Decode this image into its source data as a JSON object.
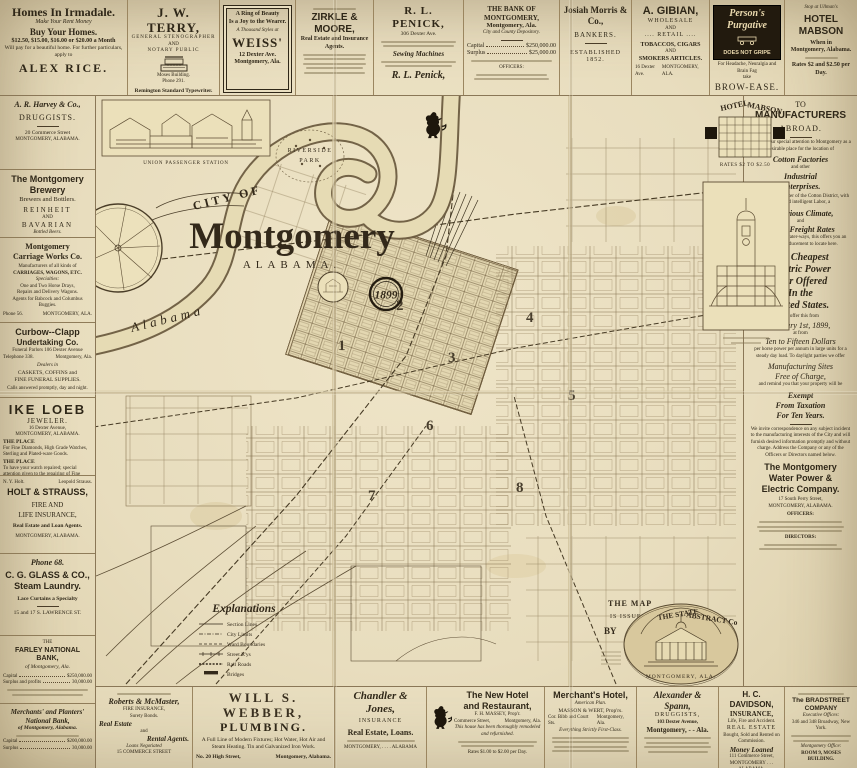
{
  "palette": {
    "paper": "#e9dec0",
    "ink": "#2f2718"
  },
  "map": {
    "ribbon": "CITY OF",
    "title": "Montgomery",
    "state": "ALABAMA.",
    "year": "1899",
    "river": "Alabama",
    "park1": "RIVERSIDE",
    "park2": "PARK",
    "station_caption": "UNION PASSENGER STATION",
    "wards": [
      "1",
      "2",
      "3",
      "4",
      "5",
      "6",
      "7",
      "8"
    ],
    "legend": {
      "title": "Explanations",
      "items": [
        "Section Lines",
        "City Limits",
        "Ward Boundaries",
        "Street R'ys",
        "Rail Roads",
        "Bridges"
      ]
    },
    "issued": {
      "l1": "THE MAP",
      "l2": "IS ISSUED",
      "l3": "BY",
      "n1": "THE STATE",
      "n2": "ABSTRACT Co",
      "city": "MONTGOMERY, ALA."
    }
  },
  "top": {
    "irmadale": {
      "title": "Homes In Irmadale.",
      "s1": "Make Your Rent Money",
      "s2": "Buy Your Homes.",
      "s3": "$12.50, $15.00, $16.00 or $20.00 a Month",
      "s4": "Will pay for a beautiful home. For further particulars, apply to",
      "name": "ALEX RICE."
    },
    "terry": {
      "title": "J. W. TERRY,",
      "l1": "GENERAL STENOGRAPHER",
      "l2": "AND",
      "l3": "NOTARY PUBLIC",
      "l4": "Moses Building.",
      "l5": "Phone 291.",
      "f1": "Remington Standard Typewriter.",
      "f2": "Typewriters to Rent."
    },
    "weiss": {
      "l1": "A Ring of Beauty",
      "l2": "Is a Joy to the Wearer.",
      "l3": "A Thousand Styles at",
      "name": "WEISS'",
      "a1": "12 Dexter Ave.",
      "a2": "Montgomery, Ala."
    },
    "zirkle": {
      "title": "ZIRKLE & MOORE,",
      "sub": "Real Estate and Insurance Agents."
    },
    "penick": {
      "title": "R. L. PENICK,",
      "sub": "306 Dexter Ave.",
      "mid": "Sewing Machines",
      "sig": "R. L. Penick,"
    },
    "bank": {
      "title": "THE BANK OF MONTGOMERY,",
      "sub": "Montgomery, Ala.",
      "dep": "City and County Depository.",
      "cl": "Capital",
      "cv": "$250,000.00",
      "sl": "Surplus",
      "sv": "$25,000.00",
      "off": "OFFICERS:"
    },
    "morris": {
      "title": "Josiah Morris & Co.,",
      "sub": "BANKERS.",
      "est": "ESTABLISHED 1852."
    },
    "gibian": {
      "title": "A. GIBIAN,",
      "l1": "WHOLESALE",
      "l2": "AND",
      "l3": ".... RETAIL ....",
      "l4": "TOBACCOS, CIGARS",
      "l5": "AND",
      "l6": "SMOKERS ARTICLES.",
      "a1": "16 Dexter Ave.",
      "a2": "MONTGOMERY, ALA."
    },
    "persons": {
      "b1": "Person's",
      "b2": "Purgative",
      "b3": "DOES NOT GRIPE",
      "n1": "For Headache, Neuralgia and Brain Fag",
      "n2": "take",
      "tag": "BROW-EASE."
    },
    "mabson": {
      "tiny": "Stop at Ullman's",
      "title": "HOTEL MABSON",
      "l1": "When in",
      "l2": "Montgomery, Alabama.",
      "rates": "Rates $2 and $2.50 per Day."
    }
  },
  "left": {
    "harvey": {
      "title": "A. R. Harvey & Co.,",
      "sub": "DRUGGISTS.",
      "a1": "20 Commerce Street",
      "a2": "MONTGOMERY, ALABAMA."
    },
    "brewery": {
      "t1": "The Montgomery",
      "t2": "Brewery",
      "sub": "Brewers and Bottlers.",
      "b1": "REINHEIT",
      "and": "AND",
      "b2": "BAVARIAN",
      "note": "Bottled Beers."
    },
    "carriage": {
      "t1": "Montgomery",
      "t2": "Carriage Works Co.",
      "l1": "Manufacturers of all kinds of",
      "l2": "CARRIAGES, WAGONS, ETC.",
      "l3": "Specialties:",
      "l4": "One and Two Horse Drays,",
      "l5": "Repairs and Delivery Wagons.",
      "l6": "Agents for Babcock and Columbus Buggies.",
      "phone": "Phone 56.",
      "city": "MONTGOMERY, ALA."
    },
    "curbow": {
      "t1": "Curbow--Clapp",
      "t2": "Undertaking Co.",
      "l1": "Funeral Parlors 106 Dexter Avenue",
      "l2": "Telephone 338.",
      "l3": "Montgomery, Ala.",
      "l4": "Dealers in",
      "l5": "CASKETS, COFFINS and",
      "l6": "FINE FUNERAL SUPPLIES.",
      "l7": "Calls answered promptly, day and night."
    },
    "loeb": {
      "title": "IKE LOEB",
      "sub": "JEWELER.",
      "a1": "16 Dexter Avenue,",
      "a2": "MONTGOMERY, ALABAMA.",
      "h1": "THE PLACE",
      "p1": "For Fine Diamonds, High Grade Watches, Sterling and Plated-ware Goods.",
      "h2": "THE PLACE",
      "p2": "To have your watch repaired; special attention given to the repairing of Fine Watches."
    },
    "holt": {
      "tiny1": "N. Y. Holt.",
      "tiny2": "Leopold Strauss.",
      "title": "HOLT & STRAUSS,",
      "l1": "FIRE AND",
      "l2": "LIFE INSURANCE,",
      "l3": "Real Estate and Loan Agents.",
      "city": "MONTGOMERY, ALABAMA."
    },
    "glass": {
      "phone": "Phone 68.",
      "t1": "C. G. GLASS & CO.,",
      "t2": "Steam Laundry.",
      "sub": "Lace Curtains a Specialty",
      "addr": "15 and 17 S. LAWRENCE ST."
    },
    "farley": {
      "pre": "THE",
      "title": "FARLEY NATIONAL BANK,",
      "sub": "of Montgomery, Ala.",
      "cl": "Capital",
      "cv": "$250,000.00",
      "sl": "Surplus and profits",
      "sv": "30,000.00"
    },
    "merchants": {
      "t1": "Merchants' and Planters'",
      "t2": "National Bank,",
      "sub": "of Montgomery, Alabama.",
      "cl": "Capital",
      "cv": "$200,000.00",
      "sl": "Surplus",
      "sv": "30,000.00"
    }
  },
  "right": {
    "man": {
      "to": "TO",
      "t": "MANUFACTURERS",
      "sub": "ABROAD.",
      "p1": "We call your special attention to Montgomery as a desirable place for the location of",
      "h1": "Cotton Factories",
      "p2": "and other",
      "h2": "Industrial",
      "h2b": "Enterprises.",
      "p3": "Located in the center of the Cotton District, with cheap and intelligent Labor, a",
      "h3": "Salubrious Climate,",
      "and": "and",
      "h4": "Cheap Freight Rates",
      "p4": "to all outbound water-ways, this offers you an unequaled inducement to locate here."
    },
    "power": {
      "h1": "The Cheapest",
      "h2": "Electric Power",
      "h3": "Ever Offered",
      "h4": "In the",
      "h5": "United States.",
      "p1": "We offer this from",
      "d1": "January 1st, 1899,",
      "p2": "at from",
      "d2": "Ten to Fifteen Dollars",
      "p3": "per horse power per annum in large units for a steady day load. To daylight parties we offer",
      "d3": "Manufacturing Sites",
      "d4": "Free of Charge,",
      "p4": "and remind you that your property will be",
      "d5": "Exempt",
      "d6": "From Taxation",
      "d7": "For Ten Years."
    },
    "co": {
      "p": "We invite correspondence on any subject incident to the manufacturing interests of the City and will furnish desired information promptly and without charge. Address the Company or any of the Officers or Directors named below.",
      "t1": "The Montgomery",
      "t2": "Water Power &",
      "t3": "Electric Company.",
      "addr": "17 South Perry Street,",
      "city": "MONTGOMERY, ALABAMA.",
      "off": "OFFICERS:",
      "dir": "DIRECTORS:"
    },
    "hotel_caption": "RATES $2 TO $2.50"
  },
  "bottom": {
    "roberts": {
      "title": "Roberts & McMaster,",
      "l1": "FIRE INSURANCE,",
      "l2": "Surety Bonds.",
      "l3": "Real Estate",
      "l4": "and",
      "l5": "Rental Agents.",
      "l6": "Loans Negotiated",
      "addr": "15 COMMERCE STREET"
    },
    "webber": {
      "title": "WILL S. WEBBER,",
      "sub": "PLUMBING.",
      "p1": "A Full Line of Modern Fixtures; Hot Water, Hot Air and",
      "p2": "Steam Heating.  Tin and Galvanized Iron Work.",
      "addr": "No. 20 High Street,",
      "city": "Montgomery, Alabama."
    },
    "chandler": {
      "title": "Chandler & Jones,",
      "l1": "INSURANCE",
      "l2": "Real Estate, Loans.",
      "city": "MONTGOMERY, . . . . ALABAMA"
    },
    "newhotel": {
      "t1": "The New Hotel",
      "t2": "and Restaurant,",
      "prop": "F. H. MASSEY, Prop'r.",
      "a1": "Commerce Street,",
      "a2": "Montgomery, Ala.",
      "note": "This house has been thoroughly remodeled and refurnished.",
      "rates": "Rates $1.00 to $2.00 per Day."
    },
    "merchhotel": {
      "title": "Merchant's Hotel,",
      "sub": "American Plan.",
      "prop": "MASSON & WERT, Prop'rs.",
      "a1": "Cor. Bibb and Court Sts.",
      "a2": "Montgomery, Ala.",
      "note": "Everything Strictly First-Class."
    },
    "alexander": {
      "title": "Alexander & Spann,",
      "sub": "DRUGGISTS,",
      "addr": "103 Dexter Avenue,",
      "city": "Montgomery,  -  -  Ala."
    },
    "davidson": {
      "title": "H. C. DAVIDSON,",
      "sub": "INSURANCE,",
      "sub2": "Life, Fire and Accident.",
      "re": "REAL ESTATE",
      "re2": "Bought, Sold and Rented on Commission.",
      "money": "Money Loaned",
      "addr": "111 Commerce Street,",
      "city": "MONTGOMERY . . . ALABAMA."
    },
    "bradstreet": {
      "title": "The BRADSTREET COMPANY",
      "l1": "Executive Offices:",
      "l2": "346 and 348 Broadway, New York.",
      "l3": "Montgomery Office:",
      "l4": "ROOM 9, MOSES BUILDING."
    }
  }
}
